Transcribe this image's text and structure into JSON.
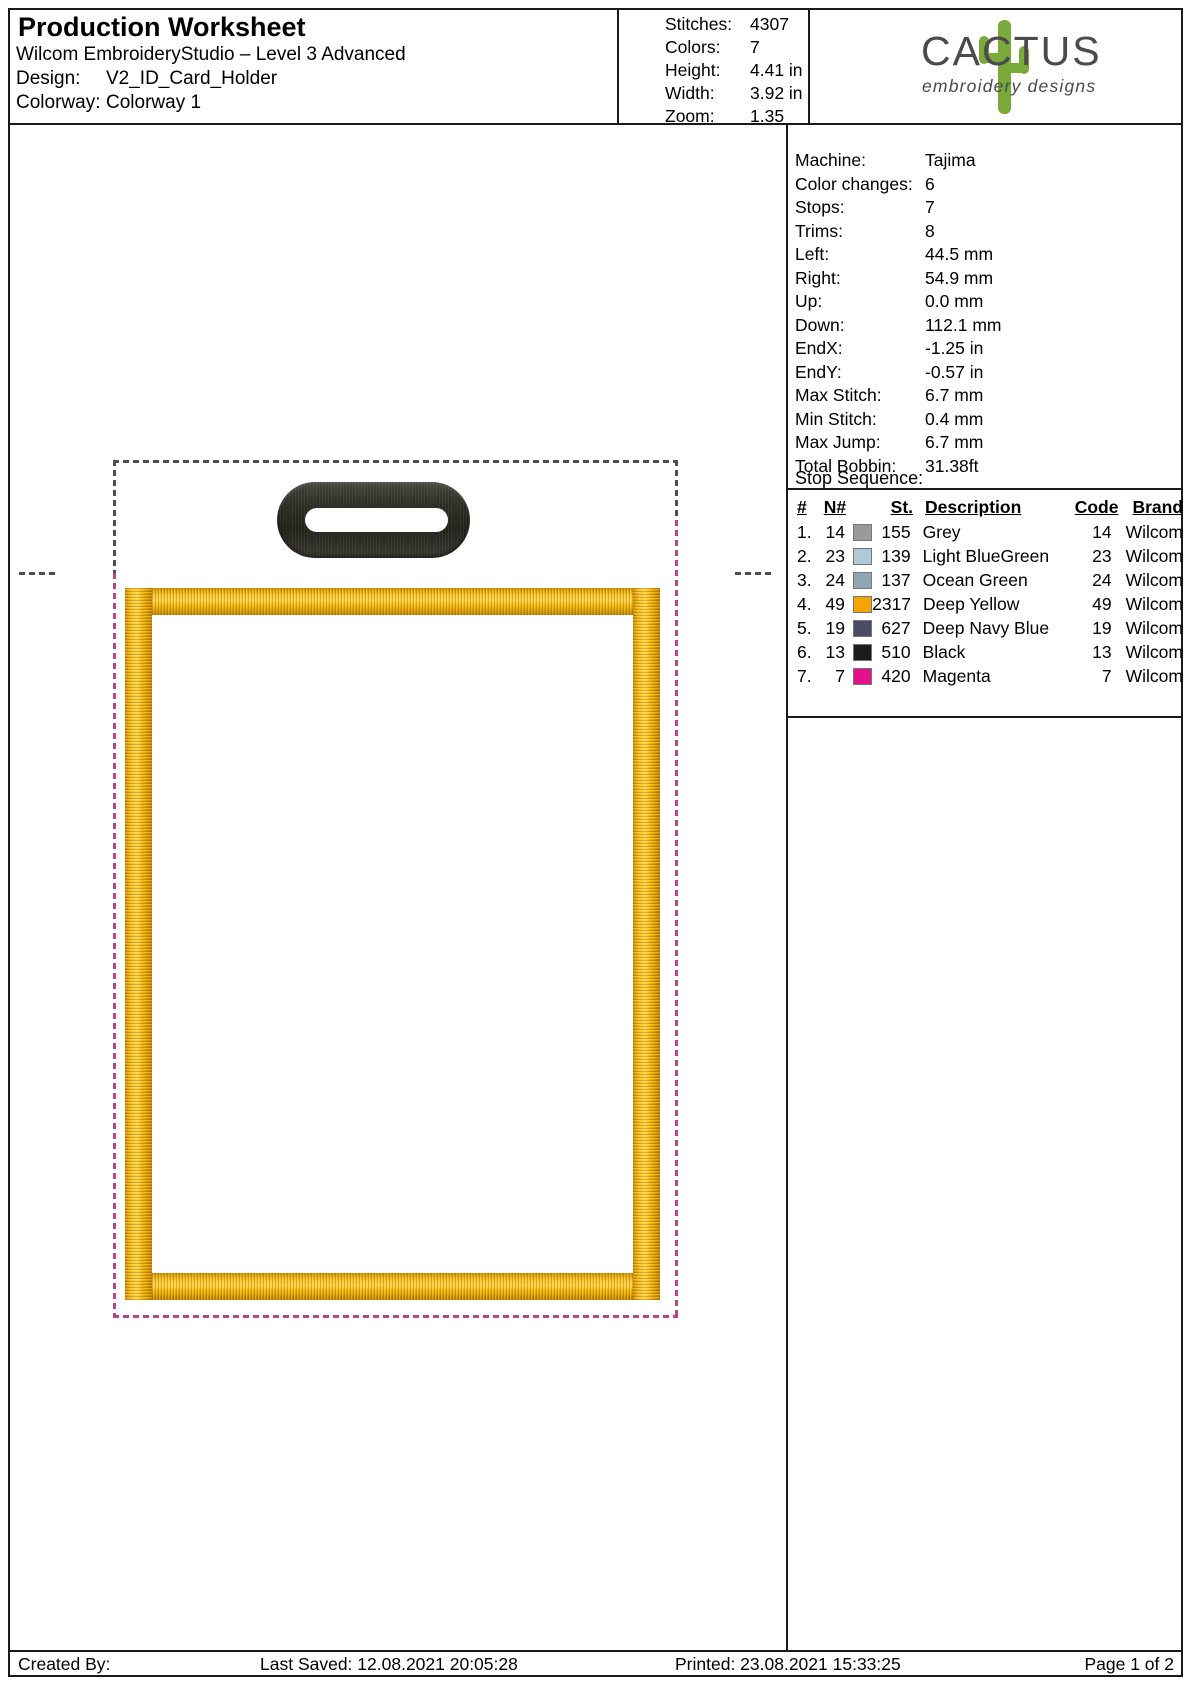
{
  "header": {
    "title": "Production Worksheet",
    "subtitle": "Wilcom EmbroideryStudio – Level 3 Advanced",
    "design_label": "Design:",
    "design_value": "V2_ID_Card_Holder",
    "colorway_label": "Colorway:",
    "colorway_value": "Colorway 1",
    "stats": [
      {
        "label": "Stitches:",
        "value": "4307"
      },
      {
        "label": "Colors:",
        "value": "7"
      },
      {
        "label": "Height:",
        "value": "4.41 in"
      },
      {
        "label": "Width:",
        "value": "3.92 in"
      },
      {
        "label": "Zoom:",
        "value": "1.35"
      }
    ],
    "logo": {
      "brand": "CACTUS",
      "tagline": "embroidery designs",
      "cactus_color": "#7aa93c",
      "text_color": "#4b4b4b"
    }
  },
  "machine_info": [
    {
      "label": "Machine:",
      "value": "Tajima"
    },
    {
      "label": "Color changes:",
      "value": "6"
    },
    {
      "label": "Stops:",
      "value": "7"
    },
    {
      "label": "Trims:",
      "value": "8"
    },
    {
      "label": "Left:",
      "value": "44.5 mm"
    },
    {
      "label": "Right:",
      "value": "54.9 mm"
    },
    {
      "label": "Up:",
      "value": "0.0 mm"
    },
    {
      "label": "Down:",
      "value": "112.1 mm"
    },
    {
      "label": "EndX:",
      "value": "-1.25 in"
    },
    {
      "label": "EndY:",
      "value": "-0.57 in"
    },
    {
      "label": "Max Stitch:",
      "value": "6.7 mm"
    },
    {
      "label": "Min Stitch:",
      "value": "0.4 mm"
    },
    {
      "label": "Max Jump:",
      "value": "6.7 mm"
    },
    {
      "label": "Total Bobbin:",
      "value": "31.38ft"
    }
  ],
  "stop_sequence": {
    "title": "Stop Sequence:",
    "columns": [
      "#",
      "N#",
      "St.",
      "Description",
      "Code",
      "Brand"
    ],
    "rows": [
      {
        "num": "1.",
        "n": "14",
        "st": "155",
        "desc": "Grey",
        "code": "14",
        "brand": "Wilcom",
        "color": "#9a9a9a"
      },
      {
        "num": "2.",
        "n": "23",
        "st": "139",
        "desc": "Light BlueGreen",
        "code": "23",
        "brand": "Wilcom",
        "color": "#b0c9d6"
      },
      {
        "num": "3.",
        "n": "24",
        "st": "137",
        "desc": "Ocean Green",
        "code": "24",
        "brand": "Wilcom",
        "color": "#8fa6b2"
      },
      {
        "num": "4.",
        "n": "49",
        "st": "2317",
        "desc": "Deep Yellow",
        "code": "49",
        "brand": "Wilcom",
        "color": "#f5a300"
      },
      {
        "num": "5.",
        "n": "19",
        "st": "627",
        "desc": "Deep Navy Blue",
        "code": "19",
        "brand": "Wilcom",
        "color": "#4b4b66"
      },
      {
        "num": "6.",
        "n": "13",
        "st": "510",
        "desc": "Black",
        "code": "13",
        "brand": "Wilcom",
        "color": "#1c1c1c"
      },
      {
        "num": "7.",
        "n": "7",
        "st": "420",
        "desc": "Magenta",
        "code": "7",
        "brand": "Wilcom",
        "color": "#e5118c"
      }
    ]
  },
  "design_preview": {
    "outline_grey": "#4e4e4e",
    "outline_magenta": "#b04a86",
    "border_yellow": "#f0ac00",
    "slot_black": "#34332b"
  },
  "footer": {
    "created_by": "Created By:",
    "last_saved": "Last Saved: 12.08.2021 20:05:28",
    "printed": "Printed: 23.08.2021 15:33:25",
    "page": "Page 1 of 2"
  }
}
